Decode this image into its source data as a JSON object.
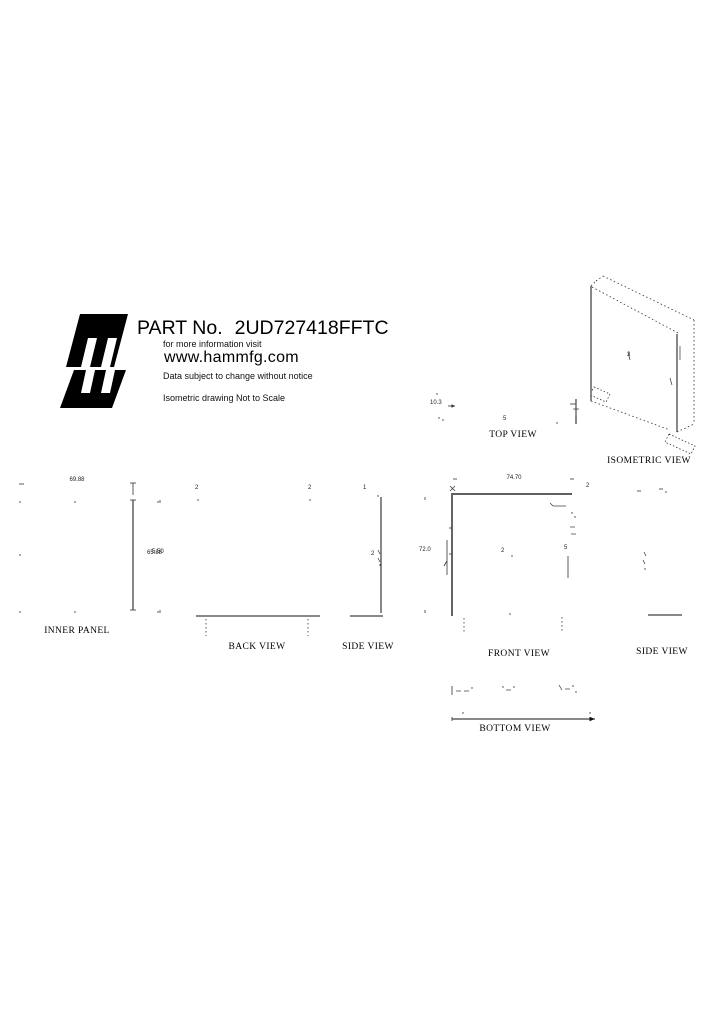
{
  "header": {
    "part_label": "PART No.",
    "part_number": "2UD727418FFTC",
    "info_line": "for more information visit",
    "website": "www.hammfg.com",
    "notice": "Data subject to change without notice",
    "iso_note": "Isometric drawing Not to Scale"
  },
  "views": {
    "top": {
      "label": "TOP VIEW",
      "depth_dim": "10.3",
      "callout": "5"
    },
    "isometric": {
      "label": "ISOMETRIC VIEW",
      "callout": "3"
    },
    "inner_panel": {
      "label": "INNER PANEL",
      "width_dim": "69.88",
      "height_dim": "65.88"
    },
    "back": {
      "label": "BACK VIEW",
      "callout_left": "2",
      "callout_right": "2",
      "side_dim": "5.50"
    },
    "side_left": {
      "label": "SIDE VIEW",
      "callout_top": "1",
      "callout_mid": "2"
    },
    "front": {
      "label": "FRONT VIEW",
      "width_dim": "74.70",
      "height_dim": "72.0",
      "corner_callout": "2",
      "center_callout": "2",
      "right_callout": "5"
    },
    "side_right": {
      "label": "SIDE VIEW"
    },
    "bottom": {
      "label": "BOTTOM VIEW"
    }
  },
  "colors": {
    "ink": "#000000",
    "line": "#333333"
  }
}
